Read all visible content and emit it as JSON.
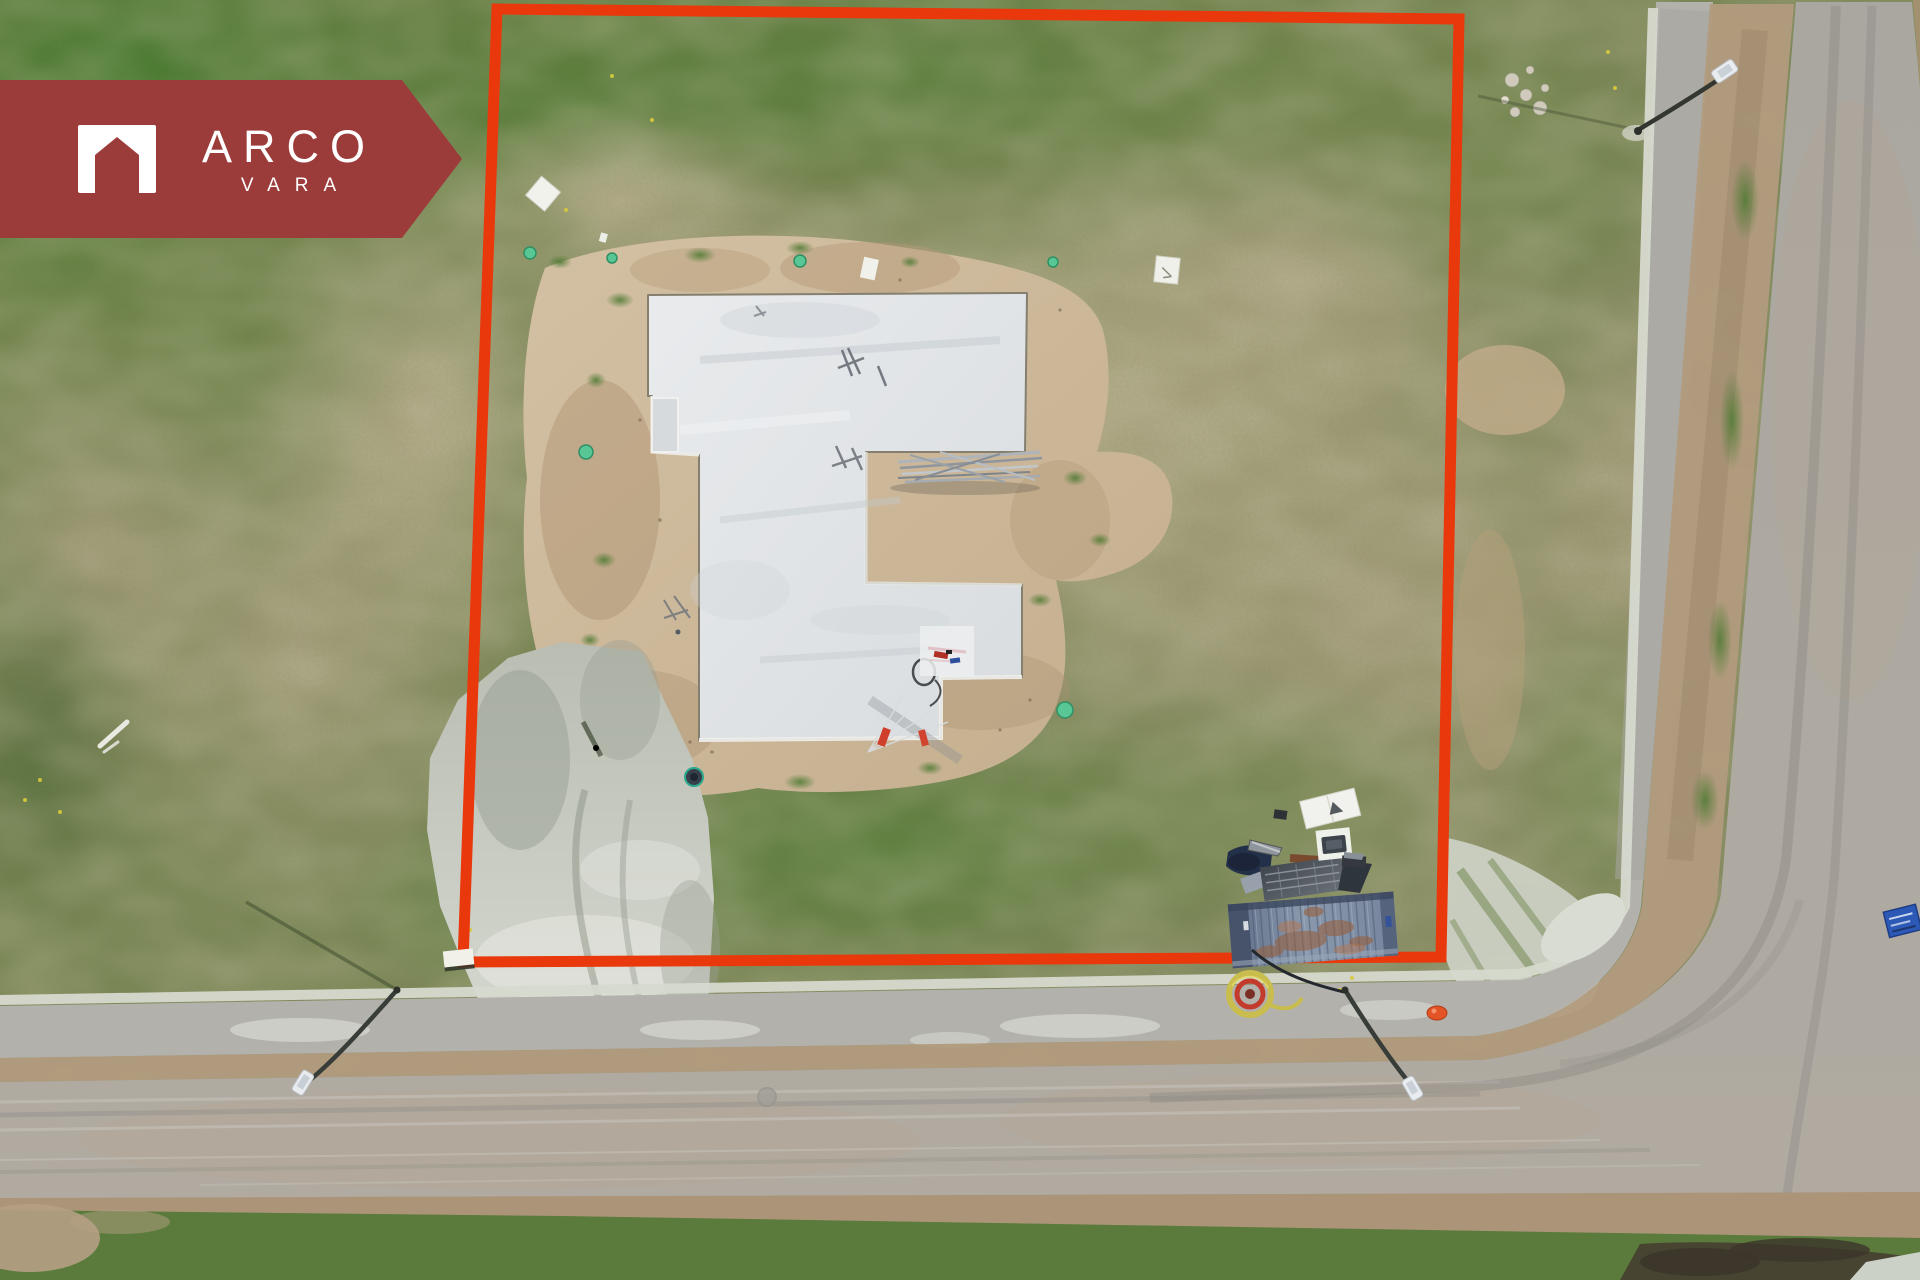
{
  "branding": {
    "name_primary": "ARCO",
    "name_secondary": "VARA",
    "logo_icon": "house-arch-icon"
  },
  "palette": {
    "banner_red": "#9c3c3a",
    "boundary_red": "#e9380b",
    "grass_green": "#5e7c40",
    "dry_grass": "#a89e7e",
    "sand": "#cdb999",
    "concrete_slab": "#e2e5e8",
    "asphalt": "#a9a6a0",
    "gravel": "#ccd0c6",
    "container_blue": "#7b89a1",
    "safety_orange": "#e25426",
    "hose_yellow": "#c9bd4e",
    "sign_blue": "#2c59b5"
  },
  "scene": {
    "description": "Aerial drone photo of a vacant building plot outlined in red, with a poured concrete foundation slab, sand pad, gravel driveway, construction container with equipment, street lights and adjacent gravel roads meeting at a junction"
  }
}
